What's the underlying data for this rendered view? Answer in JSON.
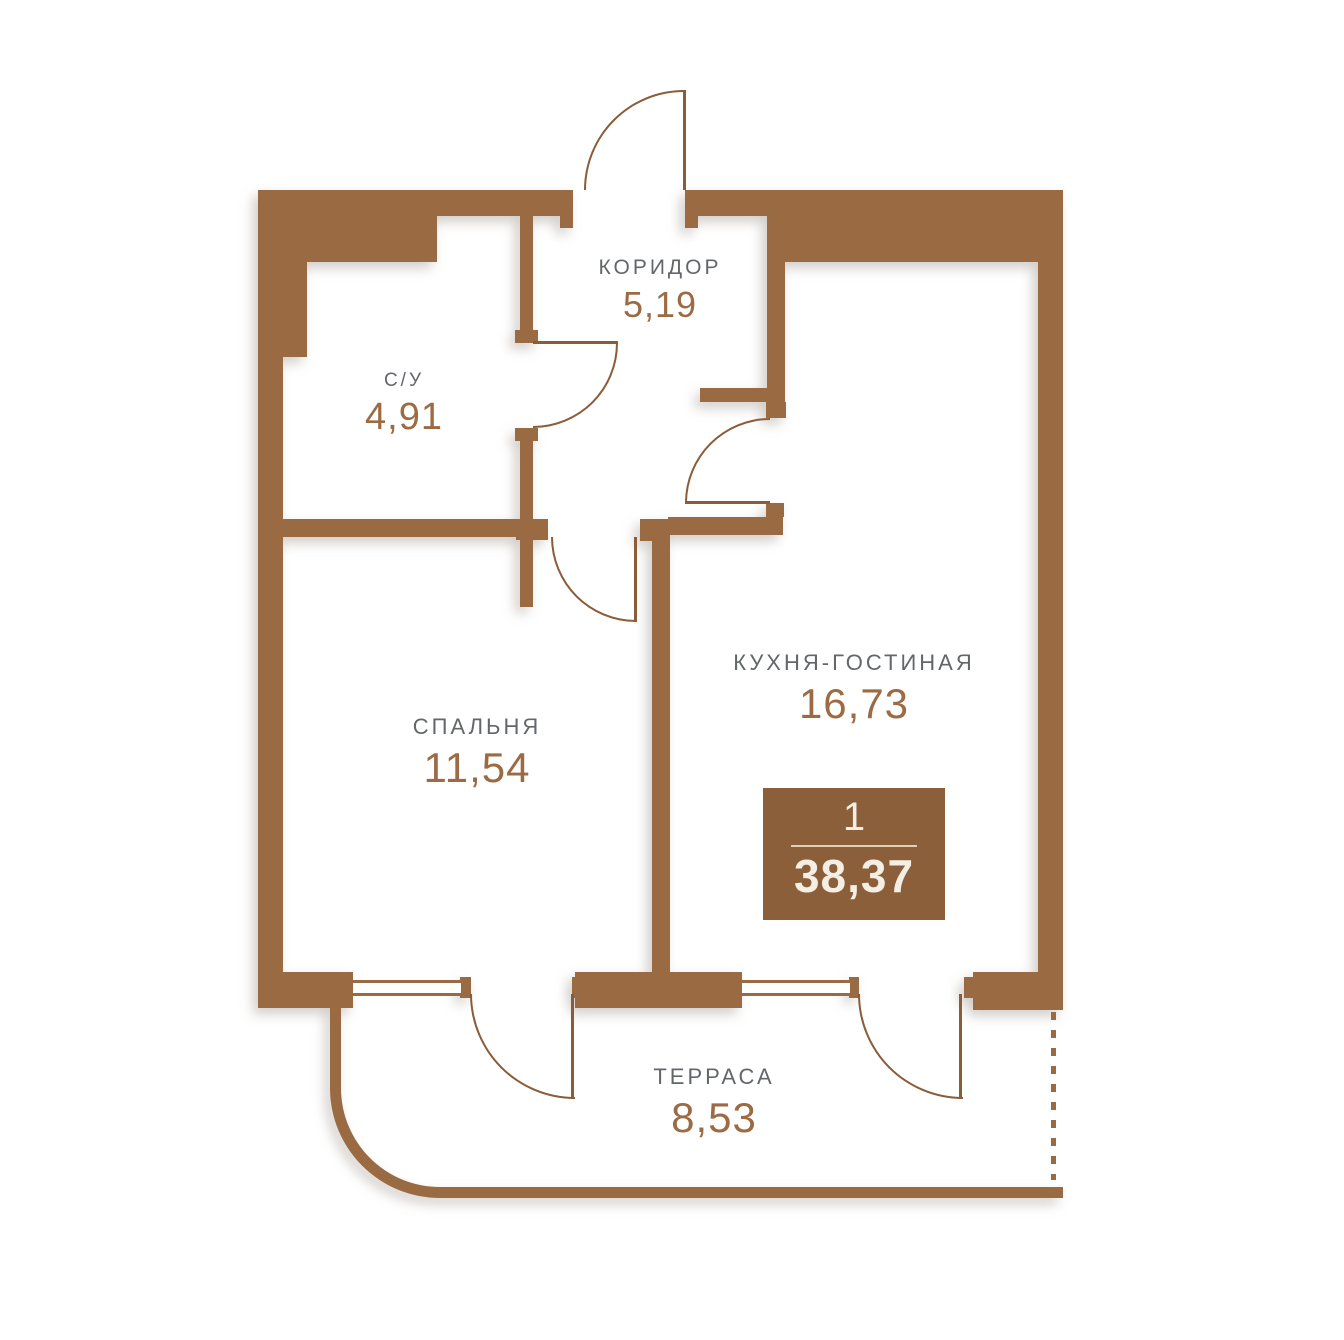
{
  "canvas": {
    "width": 1344,
    "height": 1340
  },
  "rooms": [
    {
      "name": "КОРИДОР",
      "area": "5,19"
    },
    {
      "name": "С/У",
      "area": "4,91"
    },
    {
      "name": "СПАЛЬНЯ",
      "area": "11,54"
    },
    {
      "name": "КУХНЯ-ГОСТИНАЯ",
      "area": "16,73"
    },
    {
      "name": "ТЕРРАСА",
      "area": "8,53"
    }
  ],
  "badge": {
    "rooms_count": "1",
    "total_area": "38,37"
  },
  "colors": {
    "wall": "#9A6A42",
    "line": "#8A5C38",
    "label": "#63666B",
    "number": "#9C6B44",
    "badge-bg": "#8B5F3A",
    "badge-text": "#F4EEE4",
    "badge-divider": "#E0CFB4",
    "bg": "#FFFFFF"
  }
}
